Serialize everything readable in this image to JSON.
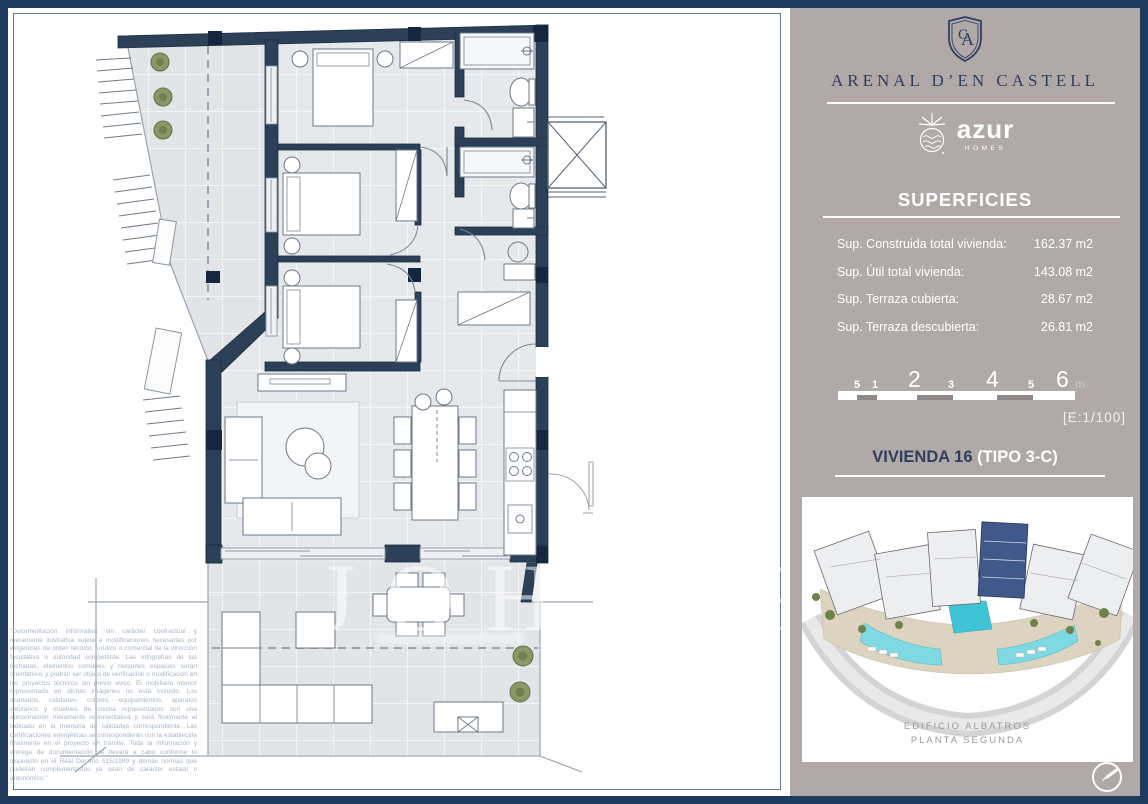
{
  "branding": {
    "monogram_c": "C",
    "monogram_a": "A",
    "project": "ARENAL D’EN CASTELL",
    "developer": "azur",
    "developer_sub": "HOMES"
  },
  "superficies": {
    "title": "SUPERFICIES",
    "rows": [
      {
        "label": "Sup. Construida total vivienda:",
        "value": "162.37 m2"
      },
      {
        "label": "Sup. Útil total vivienda:",
        "value": "143.08 m2"
      },
      {
        "label": "Sup. Terraza cubierta:",
        "value": "28.67 m2"
      },
      {
        "label": "Sup. Terraza descubierta:",
        "value": "26.81 m2"
      }
    ]
  },
  "scale": {
    "marks": [
      "5",
      "1",
      "2",
      "3",
      "4",
      "5",
      "6"
    ],
    "unit": "m",
    "ratio": "[E:1/100]"
  },
  "unit": {
    "name": "VIVIENDA 16",
    "type": "(TIPO 3-C)"
  },
  "siteplan": {
    "caption_line1": "EDIFICIO ALBATROS",
    "caption_line2": "PLANTA SEGUNDA"
  },
  "watermark": {
    "text": "JOHN",
    "text2": "R"
  },
  "disclaimer": "\"Documentación informativa sin carácter contractual y meramente ilustrativa sujeta a modificaciones necesarias por exigencias de orden técnico, jurídico o comercial de la dirección facultativa o autoridad competente. Las infografías de las fachadas, elementos comunes y restantes espacios serán orientativos y podrán ser objeto de verificación o modificación en los proyectos técnicos sin previo aviso. El mobiliario interior representado en dichas imágenes no está incluido. Los acabados, calidades, colores, equipamientos, aparatos sanitarios y muebles de cocina representados son una aproximación meramente representativa y será finalmente el indicado en la memoria de calidades correspondiente. Las certificaciones energéticas se corresponderán con la establecida finalmente en el proyecto en trámite. Toda la información y entrega de documentación se llevará a cabo conforme lo dispuesto en el Real Decreto 515/1989 y demás normas que pudieran complementarlas ya sean de carácter estatal o autonómico.\"",
  "colors": {
    "wall_navy": "#2c4157",
    "frame_navy": "#1e3a5c",
    "sidebar_taupe": "#b1a9a7",
    "brand_navy": "#2e3f5e",
    "highlight_building": "#41598a",
    "pool": "#7ed9e2",
    "deck": "#dcd4c0"
  }
}
